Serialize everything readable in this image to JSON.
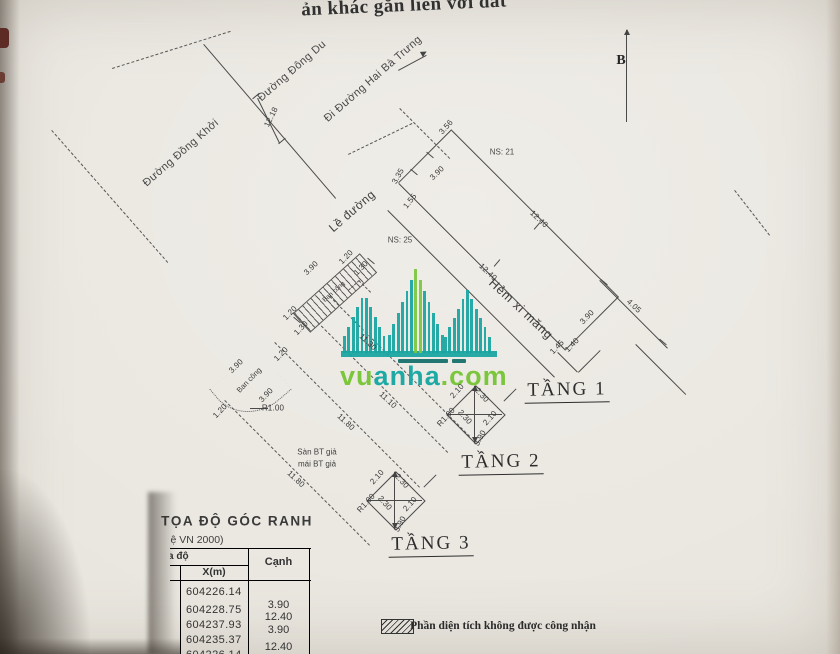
{
  "paper_bg": "#e9e6df",
  "watermark": {
    "teal": "#1ea9a4",
    "green": "#7cc63e",
    "letters": [
      [
        "v",
        "g"
      ],
      [
        "u",
        "g"
      ],
      [
        "a",
        "t"
      ],
      [
        "n",
        "t"
      ],
      [
        "h",
        "t"
      ],
      [
        "a",
        "t"
      ],
      [
        ".",
        "g"
      ],
      [
        "c",
        "g"
      ],
      [
        "o",
        "g"
      ],
      [
        "m",
        "g"
      ]
    ]
  },
  "table": {
    "col_group": "a độ",
    "col_x": "X(m)",
    "col_canh": "Cạnh",
    "x_values": [
      "604226.14",
      "604228.75",
      "604237.93",
      "604235.37",
      "604226.14"
    ],
    "canh_values": [
      "3.90",
      "12.40",
      "3.90",
      "12.40"
    ]
  },
  "annotations": [
    {
      "name": "doc-title-fragment",
      "text": "ản khác gắn liền với đất",
      "x": 404,
      "y": 6,
      "r": -2.5,
      "cls": "a-big"
    },
    {
      "name": "north-label",
      "text": "B",
      "x": 621,
      "y": 61,
      "r": 0,
      "cls": "a-north"
    },
    {
      "name": "street-label-dong-du",
      "text": "Đường Đông Du",
      "x": 292,
      "y": 71,
      "r": -41,
      "cls": "a-street"
    },
    {
      "name": "street-label-hai-ba-trung",
      "text": "Đi Đường Hai Bà Trưng",
      "x": 373,
      "y": 79,
      "r": -41,
      "cls": "a-street"
    },
    {
      "name": "street-label-dong-khoi",
      "text": "Đường Đồng Khởi",
      "x": 181,
      "y": 153,
      "r": -41,
      "cls": "a-street"
    },
    {
      "name": "sidewalk-label",
      "text": "Lề đường",
      "x": 352,
      "y": 211,
      "r": -41,
      "cls": "a-road"
    },
    {
      "name": "alley-label",
      "text": "Hẻm xi măng",
      "x": 521,
      "y": 309,
      "r": 43,
      "cls": "a-alley"
    },
    {
      "name": "dim-street-12-18",
      "text": "12.18",
      "x": 271,
      "y": 117,
      "r": -63,
      "cls": "a-dim"
    },
    {
      "name": "house-code-25",
      "text": "NS: 25",
      "x": 400,
      "y": 240,
      "r": 0,
      "cls": "a-code"
    },
    {
      "name": "house-code-21",
      "text": "NS: 21",
      "x": 502,
      "y": 152,
      "r": 0,
      "cls": "a-code"
    },
    {
      "name": "dim-3-56",
      "text": "3.56",
      "x": 446,
      "y": 127,
      "r": -48,
      "cls": "a-dim"
    },
    {
      "name": "dim-front-3-90",
      "text": "3.90",
      "x": 437,
      "y": 173,
      "r": -44,
      "cls": "a-dim"
    },
    {
      "name": "dim-1-55",
      "text": "1.55",
      "x": 410,
      "y": 201,
      "r": -52,
      "cls": "a-dim"
    },
    {
      "name": "dim-3-35",
      "text": "3.35",
      "x": 398,
      "y": 176,
      "r": -60,
      "cls": "a-dim"
    },
    {
      "name": "dim-side-12-40-a",
      "text": "12.40",
      "x": 539,
      "y": 219,
      "r": 43,
      "cls": "a-dim"
    },
    {
      "name": "dim-side-12-40-b",
      "text": "12.40",
      "x": 488,
      "y": 272,
      "r": 43,
      "cls": "a-dim"
    },
    {
      "name": "dim-4-05",
      "text": "4.05",
      "x": 634,
      "y": 306,
      "r": 43,
      "cls": "a-dim"
    },
    {
      "name": "dim-rear-3-90",
      "text": "3.90",
      "x": 587,
      "y": 317,
      "r": -46,
      "cls": "a-dim"
    },
    {
      "name": "dim-1-45",
      "text": "1.45",
      "x": 557,
      "y": 347,
      "r": -46,
      "cls": "a-dim"
    },
    {
      "name": "dim-1-40",
      "text": "1.40",
      "x": 572,
      "y": 345,
      "r": -46,
      "cls": "a-dim"
    },
    {
      "name": "dim-roof-3-90",
      "text": "3.90",
      "x": 311,
      "y": 268,
      "r": -44,
      "cls": "a-dim"
    },
    {
      "name": "dim-roof-1-20-a",
      "text": "1.20",
      "x": 346,
      "y": 257,
      "r": -46,
      "cls": "a-dim"
    },
    {
      "name": "dim-roof-1-30-a",
      "text": "1.30",
      "x": 361,
      "y": 268,
      "r": -46,
      "cls": "a-dim"
    },
    {
      "name": "dim-roof-1-20-b",
      "text": "1.20",
      "x": 290,
      "y": 313,
      "r": -46,
      "cls": "a-dim"
    },
    {
      "name": "dim-roof-1-30-b",
      "text": "1.30",
      "x": 301,
      "y": 328,
      "r": -46,
      "cls": "a-dim"
    },
    {
      "name": "hatch-strip-label",
      "text": "Ban công",
      "x": 334,
      "y": 292,
      "r": -42,
      "cls": "a-hlab"
    },
    {
      "name": "dim-balcony-3-90-a",
      "text": "3.90",
      "x": 236,
      "y": 366,
      "r": -44,
      "cls": "a-dim"
    },
    {
      "name": "balcony-label",
      "text": "Ban công",
      "x": 249,
      "y": 380,
      "r": -46,
      "cls": "a-balc"
    },
    {
      "name": "dim-balcony-1-20-a",
      "text": "1.20",
      "x": 281,
      "y": 354,
      "r": -46,
      "cls": "a-dim"
    },
    {
      "name": "dim-balcony-3-90-b",
      "text": "3.90",
      "x": 266,
      "y": 395,
      "r": -46,
      "cls": "a-dim"
    },
    {
      "name": "dim-balcony-r1-00",
      "text": "R1.00",
      "x": 273,
      "y": 408,
      "r": 0,
      "cls": "a-dim"
    },
    {
      "name": "dim-balcony-1-20-b",
      "text": "1.20",
      "x": 220,
      "y": 411,
      "r": -46,
      "cls": "a-dim"
    },
    {
      "name": "dim-depth-11-30",
      "text": "11.30",
      "x": 368,
      "y": 342,
      "r": 43,
      "cls": "a-dim"
    },
    {
      "name": "dim-depth-11-10",
      "text": "11.10",
      "x": 388,
      "y": 400,
      "r": 43,
      "cls": "a-dim"
    },
    {
      "name": "dim-depth-11-80-a",
      "text": "11.80",
      "x": 346,
      "y": 422,
      "r": 43,
      "cls": "a-dim"
    },
    {
      "name": "dim-depth-11-80-b",
      "text": "11.80",
      "x": 296,
      "y": 479,
      "r": 43,
      "cls": "a-dim"
    },
    {
      "name": "note-san-bt-gia",
      "text": "Sàn BT giả",
      "x": 317,
      "y": 452,
      "r": 0,
      "cls": "a-note"
    },
    {
      "name": "note-mai-bt-gia",
      "text": "mái BT giả",
      "x": 317,
      "y": 464,
      "r": 0,
      "cls": "a-note"
    },
    {
      "name": "t2-dim-2-10-a",
      "text": "2.10",
      "x": 457,
      "y": 391,
      "r": -48,
      "cls": "a-dim"
    },
    {
      "name": "t2-dim-2-30-a",
      "text": "2.30",
      "x": 482,
      "y": 395,
      "r": 48,
      "cls": "a-dim"
    },
    {
      "name": "t2-dim-2-30-b",
      "text": "2.30",
      "x": 465,
      "y": 417,
      "r": 48,
      "cls": "a-dim"
    },
    {
      "name": "t2-dim-2-10-b",
      "text": "2.10",
      "x": 490,
      "y": 418,
      "r": -48,
      "cls": "a-dim"
    },
    {
      "name": "t2-dim-r1-00",
      "text": "R1.00",
      "x": 446,
      "y": 417,
      "r": -48,
      "cls": "a-dim"
    },
    {
      "name": "t2-dim-3-90",
      "text": "3.90",
      "x": 480,
      "y": 438,
      "r": -62,
      "cls": "a-dim"
    },
    {
      "name": "t3-dim-2-10-a",
      "text": "2.10",
      "x": 377,
      "y": 477,
      "r": -48,
      "cls": "a-dim"
    },
    {
      "name": "t3-dim-2-30-a",
      "text": "2.30",
      "x": 402,
      "y": 481,
      "r": 48,
      "cls": "a-dim"
    },
    {
      "name": "t3-dim-2-30-b",
      "text": "2.30",
      "x": 385,
      "y": 503,
      "r": 48,
      "cls": "a-dim"
    },
    {
      "name": "t3-dim-2-10-b",
      "text": "2.10",
      "x": 410,
      "y": 504,
      "r": -48,
      "cls": "a-dim"
    },
    {
      "name": "t3-dim-r1-00",
      "text": "R1.00",
      "x": 366,
      "y": 503,
      "r": -48,
      "cls": "a-dim"
    },
    {
      "name": "t3-dim-3-90",
      "text": "3.90",
      "x": 400,
      "y": 524,
      "r": -62,
      "cls": "a-dim"
    },
    {
      "name": "floor-label-1",
      "text": "TẦNG 1",
      "x": 567,
      "y": 391,
      "r": -1,
      "cls": "a-floor"
    },
    {
      "name": "floor-label-2",
      "text": "TẦNG 2",
      "x": 501,
      "y": 463,
      "r": -1,
      "cls": "a-floor"
    },
    {
      "name": "floor-label-3",
      "text": "TẦNG 3",
      "x": 431,
      "y": 545,
      "r": -1,
      "cls": "a-floor"
    },
    {
      "name": "table-title",
      "text": "TỌA ĐỘ GÓC RANH",
      "x": 237,
      "y": 521,
      "r": 0,
      "cls": "a-ttitle"
    },
    {
      "name": "table-subtitle",
      "text": "ệ VN 2000)",
      "x": 197,
      "y": 540,
      "r": 0,
      "cls": "a-tsub"
    },
    {
      "name": "legend-text",
      "text": "Phần diện tích không được công nhận",
      "x": 503,
      "y": 626,
      "r": 0,
      "cls": "a-legend"
    }
  ]
}
